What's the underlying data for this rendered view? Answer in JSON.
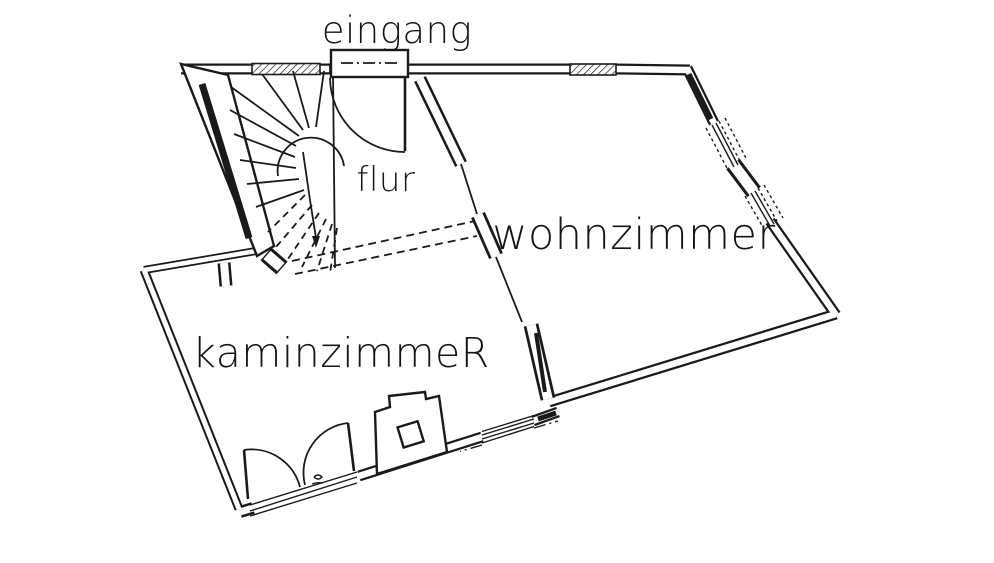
{
  "drawing": {
    "type": "floor-plan",
    "ink_color": "#1a1a1a",
    "paper_color": "#ffffff"
  },
  "rooms": {
    "eingang": {
      "label": "eingang"
    },
    "flur": {
      "label": "flur"
    },
    "wohnzimmer": {
      "label": "wohnzimmer"
    },
    "kaminzimmer": {
      "label": "kaminzimmeR"
    }
  }
}
